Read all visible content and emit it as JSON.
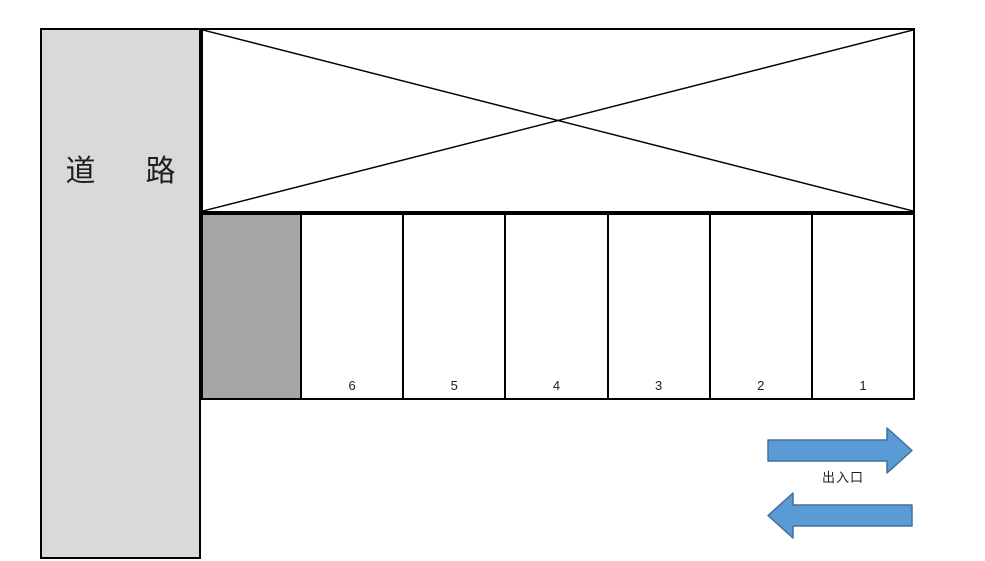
{
  "road": {
    "label": "道　路"
  },
  "blocked_area": {
    "marking": "x-cross"
  },
  "parking": {
    "spaces": [
      {
        "label": "",
        "occupied": true
      },
      {
        "label": "6",
        "occupied": false
      },
      {
        "label": "5",
        "occupied": false
      },
      {
        "label": "4",
        "occupied": false
      },
      {
        "label": "3",
        "occupied": false
      },
      {
        "label": "2",
        "occupied": false
      },
      {
        "label": "1",
        "occupied": false
      }
    ]
  },
  "gate": {
    "label": "出入口"
  },
  "colors": {
    "road_fill": "#d9d9d9",
    "occupied_fill": "#a6a6a6",
    "line": "#000000",
    "arrow_fill": "#5b9bd5",
    "arrow_stroke": "#41719c",
    "text": "#1f1f1f"
  }
}
